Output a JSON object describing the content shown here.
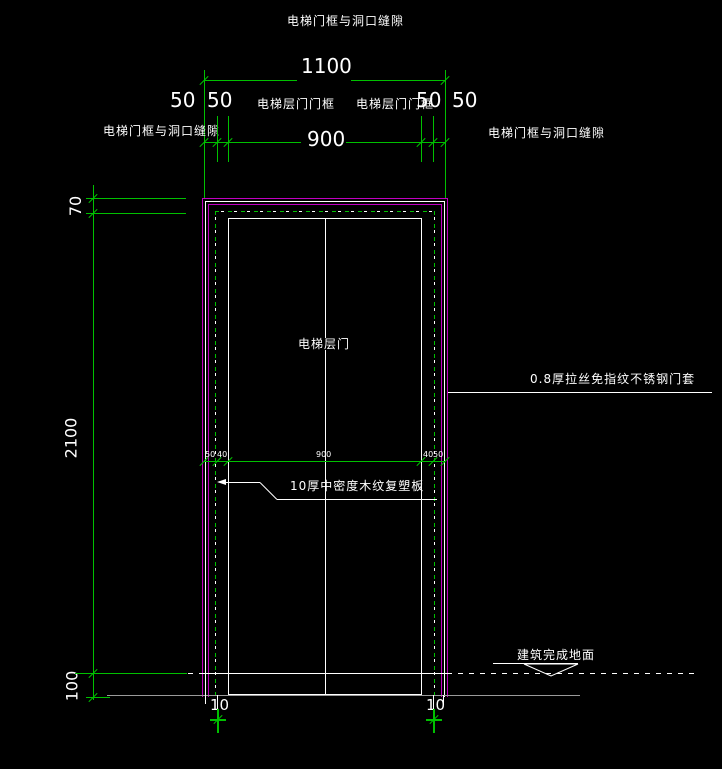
{
  "title": "电梯门框与洞口缝隙",
  "colors": {
    "background": "#000000",
    "dimension_green": "#00c000",
    "frame_magenta": "#c000c0",
    "drawing_white": "#ffffff",
    "sill_gray": "#9a9a9a"
  },
  "top_dimensions": {
    "overall": "1100",
    "opening": "900",
    "gap_left_outer": "50",
    "frame_left": "50",
    "frame_right": "50",
    "gap_right_outer": "50",
    "frame_label_left": "电梯层门门框",
    "frame_label_right": "电梯层门门框",
    "gap_note_left": "电梯门框与洞口缝隙",
    "gap_note_right": "电梯门框与洞口缝隙"
  },
  "left_dimensions": {
    "lintel": "70",
    "door_height": "2100",
    "floor": "100"
  },
  "mid_dimensions": {
    "left_outer": "50",
    "left_inner": "40",
    "opening": "900",
    "right_inner": "40",
    "right_outer": "50"
  },
  "bottom_dimensions": {
    "left": "10",
    "right": "10"
  },
  "annotations": {
    "door_label": "电梯层门",
    "panel_note": "10厚中密度木纹复塑板",
    "frame_note": "0.8厚拉丝免指纹不锈钢门套",
    "floor_note": "建筑完成地面"
  }
}
